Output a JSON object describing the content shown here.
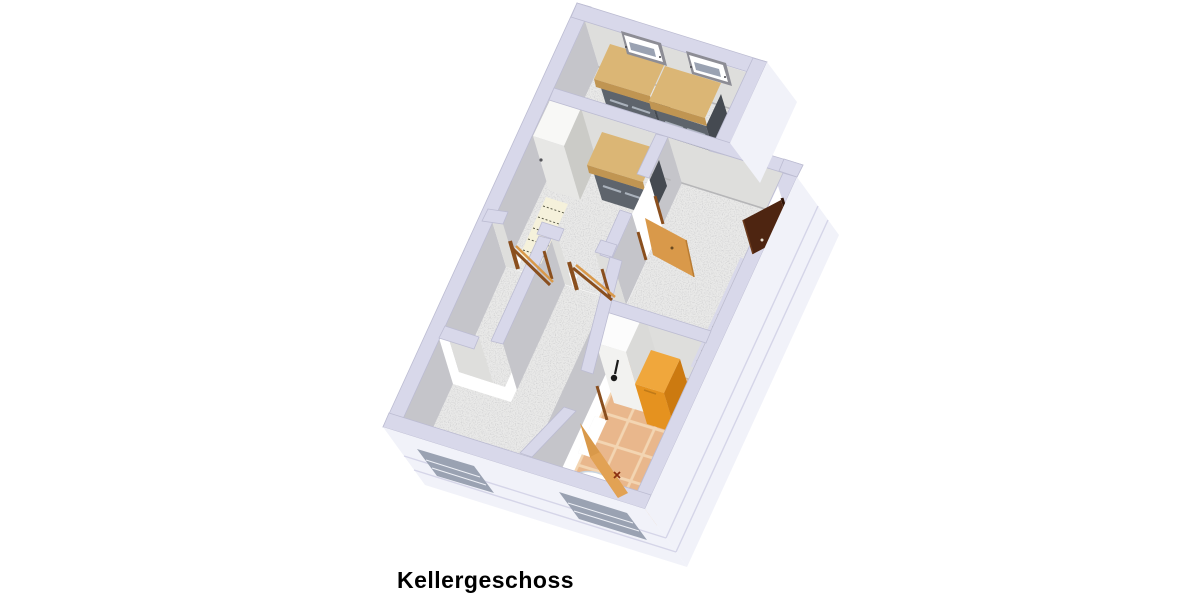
{
  "floorplan": {
    "label": "Kellergeschoss",
    "view": "3d-perspective-floorplan",
    "items": [
      {
        "name": "workbench",
        "count": 3
      },
      {
        "name": "chest-freezer",
        "count": 1
      },
      {
        "name": "storage-shelf",
        "count": 1
      },
      {
        "name": "heating-boiler",
        "count": 1
      },
      {
        "name": "storage-chest",
        "count": 1
      },
      {
        "name": "washbasin",
        "count": 1
      },
      {
        "name": "toilet",
        "count": 1
      },
      {
        "name": "staircase",
        "count": 1
      },
      {
        "name": "wood-door-open",
        "count": 4
      },
      {
        "name": "dark-door-open",
        "count": 1
      },
      {
        "name": "basement-window",
        "count": 4
      }
    ]
  },
  "palette": {
    "bg": "#ffffff",
    "wall_top": "#d8d8ea",
    "wall_top_line": "#b9b9cf",
    "wall_inner_light": "#dededc",
    "wall_inner_mid": "#c5c5ca",
    "wall_inner_dark": "#9a9aa2",
    "wall_exterior": "#f1f2f9",
    "slab_line": "#d5d5e8",
    "floor_concrete": "#e9e9e8",
    "floor_tile": "#e9b78c",
    "tile_grout": "#f3d5b2",
    "wood_top": "#dbb675",
    "wood_edge": "#c09552",
    "bench_base": "#5e646c",
    "bench_base_side": "#454a51",
    "drawer_line": "#aab2bc",
    "freezer_top": "#f8f8f6",
    "freezer_front": "#e7e7e5",
    "freezer_side": "#cbcbc7",
    "shelf_fill": "#f5f1db",
    "shelf_line": "#5a5a48",
    "door_wood": "#d9994a",
    "door_wood_dark": "#b97c33",
    "door_frame": "#8a4f1e",
    "door_brown": "#4e2511",
    "door_brown_dark": "#301406",
    "doorway_light": "#ffffff",
    "stairs_fill": "#f3ecd2",
    "stairs_line": "#8a8270",
    "boiler_top": "#fcfcfc",
    "boiler_front": "#f2f2f0",
    "boiler_side": "#dadad8",
    "chest_top": "#f0a73c",
    "chest_front": "#e5921f",
    "chest_side": "#cc7a10",
    "sink_basin": "#a9cdec",
    "sink_rim": "#ffffff",
    "toilet_fill": "#ffffff",
    "fixture_line": "#bfc9d4",
    "window_slot": "#9aa2b2",
    "window_white": "#ffffff",
    "title_color": "#000000"
  }
}
